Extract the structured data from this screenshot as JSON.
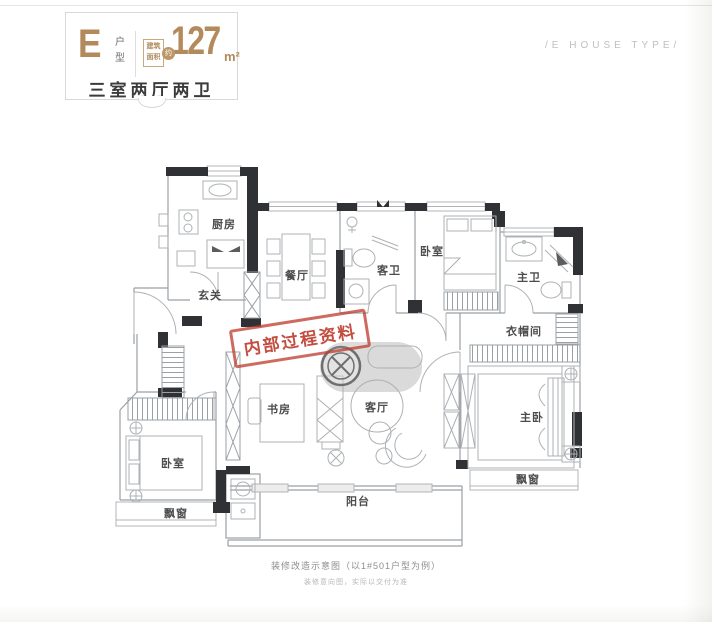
{
  "header": {
    "type_letter": "E",
    "type_suffix": "户型",
    "area_label": "建筑面积",
    "area_approx": "约",
    "area_value": "127",
    "area_unit": "m²",
    "summary": "三室两厅两卫",
    "subtitle_en": "/E HOUSE TYPE/"
  },
  "stamp": {
    "text": "内部过程资料"
  },
  "floorplan": {
    "rooms": {
      "kitchen": "厨房",
      "dining": "餐厅",
      "guest_bath": "客卫",
      "bedroom_top": "卧室",
      "master_bath": "主卫",
      "foyer": "玄关",
      "cloakroom": "衣帽间",
      "study": "书房",
      "living": "客厅",
      "master_bedroom": "主卧",
      "bedroom_left": "卧室",
      "bay_window_left": "飘窗",
      "bay_window_right": "飘窗",
      "balcony": "阳台"
    }
  },
  "caption": {
    "line1": "装修改造示意图（以1#501户型为例）",
    "line2": "装修意向图，实际以交付为准"
  },
  "colors": {
    "accent_gold": "#b28a5c",
    "stamp_red": "#c03a2b",
    "wall_dark": "#2f3134",
    "label_gray": "#4c4c4c"
  }
}
